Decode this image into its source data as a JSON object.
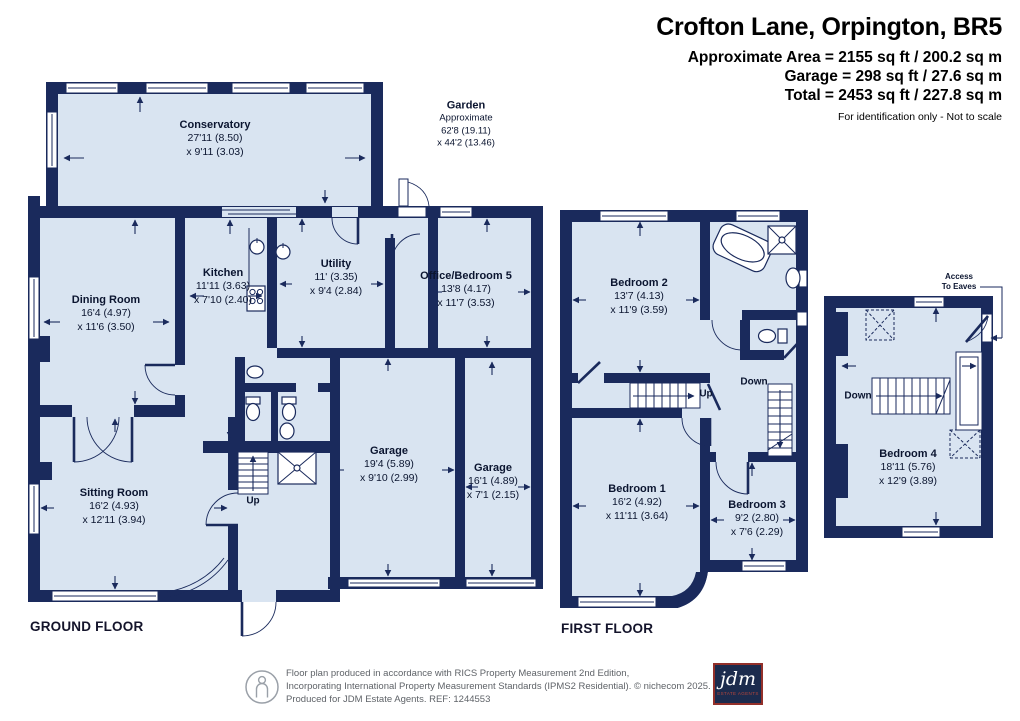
{
  "header": {
    "title": "Crofton Lane, Orpington, BR5",
    "lines": [
      "Approximate Area = 2155 sq ft / 200.2 sq m",
      "Garage = 298 sq ft / 27.6 sq m",
      "Total = 2453 sq ft / 227.8 sq m"
    ],
    "disclaimer": "For identification only - Not to scale"
  },
  "ground_floor": {
    "caption": "GROUND FLOOR",
    "stair_label": "Up",
    "garden": {
      "name": "Garden",
      "line1": "Approximate",
      "line2": "62'8 (19.11)",
      "line3": "x 44'2 (13.46)"
    },
    "rooms": {
      "conservatory": {
        "name": "Conservatory",
        "dim1": "27'11 (8.50)",
        "dim2": "x 9'11 (3.03)"
      },
      "dining": {
        "name": "Dining Room",
        "dim1": "16'4 (4.97)",
        "dim2": "x 11'6 (3.50)"
      },
      "kitchen": {
        "name": "Kitchen",
        "dim1": "11'11 (3.63)",
        "dim2": "x 7'10 (2.40)"
      },
      "utility": {
        "name": "Utility",
        "dim1": "11' (3.35)",
        "dim2": "x 9'4 (2.84)"
      },
      "office": {
        "name": "Office/Bedroom 5",
        "dim1": "13'8 (4.17)",
        "dim2": "x 11'7 (3.53)"
      },
      "sitting": {
        "name": "Sitting Room",
        "dim1": "16'2 (4.93)",
        "dim2": "x 12'11 (3.94)"
      },
      "garage1": {
        "name": "Garage",
        "dim1": "19'4 (5.89)",
        "dim2": "x 9'10 (2.99)"
      },
      "garage2": {
        "name": "Garage",
        "dim1": "16'1 (4.89)",
        "dim2": "x 7'1 (2.15)"
      }
    }
  },
  "first_floor": {
    "caption": "FIRST FLOOR",
    "stair_up_label": "Up",
    "stair_down_label": "Down",
    "rooms": {
      "bedroom2": {
        "name": "Bedroom 2",
        "dim1": "13'7 (4.13)",
        "dim2": "x 11'9 (3.59)"
      },
      "bedroom1": {
        "name": "Bedroom 1",
        "dim1": "16'2 (4.92)",
        "dim2": "x 11'11 (3.64)"
      },
      "bedroom3": {
        "name": "Bedroom 3",
        "dim1": "9'2 (2.80)",
        "dim2": "x 7'6 (2.29)"
      }
    }
  },
  "second_floor": {
    "stair_down_label": "Down",
    "eaves_line1": "Access",
    "eaves_line2": "To Eaves",
    "rooms": {
      "bedroom4": {
        "name": "Bedroom 4",
        "dim1": "18'11 (5.76)",
        "dim2": "x 12'9 (3.89)"
      }
    }
  },
  "footer": {
    "line1": "Floor plan produced in accordance with RICS Property Measurement 2nd Edition,",
    "line2": "Incorporating International Property Measurement Standards (IPMS2 Residential).   © nichecom 2025.",
    "line3": "Produced for JDM Estate Agents.    REF: 1244553",
    "logo_text": "jdm",
    "logo_subtext": "ESTATE AGENTS"
  },
  "colors": {
    "wall_navy": "#1a2a5c",
    "room_fill": "#d9e4f1",
    "logo_navy": "#1c2b4d",
    "logo_red": "#93302a"
  }
}
